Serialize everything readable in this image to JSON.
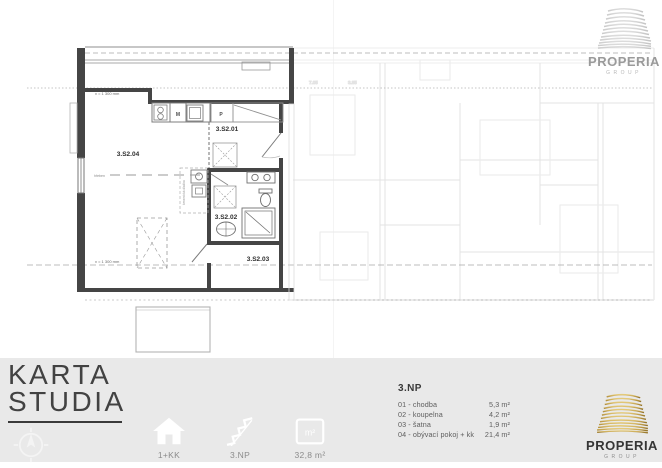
{
  "colors": {
    "accent_gold": "#c2a04c",
    "plan_wall": "#454545",
    "plan_line": "#8a8a8a",
    "faded_plan": "#e3e3e3",
    "bottom_bar_bg": "#e9e9e9",
    "title_text": "#424242",
    "muted_text": "#8c8c8c"
  },
  "header_logo": {
    "name": "PROPERIA",
    "group": "GROUP"
  },
  "footer_logo": {
    "name": "PROPERIA",
    "group": "GROUP"
  },
  "card": {
    "title_line1": "KARTA",
    "title_line2": "STUDIA"
  },
  "plan": {
    "rooms": {
      "r01": "3.S2.01",
      "r02": "3.S2.02",
      "r03": "3.S2.03",
      "r04": "3.S2.04"
    },
    "annotations": {
      "height_top": "v = 1 300 mm",
      "height_bottom": "v = 1 300 mm",
      "ridge": "hřeben",
      "floor_note": "keramická dlažba",
      "appliance_m": "M",
      "appliance_p": "P"
    },
    "background_labels": {
      "a": "7.05",
      "b": "3.85"
    }
  },
  "details": {
    "floor_heading": "3.NP",
    "rooms": [
      {
        "label": "01 - chodba",
        "area": "5,3 m²"
      },
      {
        "label": "02 - koupelna",
        "area": "4,2 m²"
      },
      {
        "label": "03 - šatna",
        "area": "1,9 m²"
      },
      {
        "label": "04 - obývací pokoj + kk",
        "area": "21,4 m²"
      }
    ]
  },
  "badges": [
    {
      "icon": "house-icon",
      "label": "1+KK"
    },
    {
      "icon": "stairs-icon",
      "label": "3.NP"
    },
    {
      "icon": "area-icon",
      "label": "32,8 m²",
      "icon_text": "m²"
    }
  ]
}
